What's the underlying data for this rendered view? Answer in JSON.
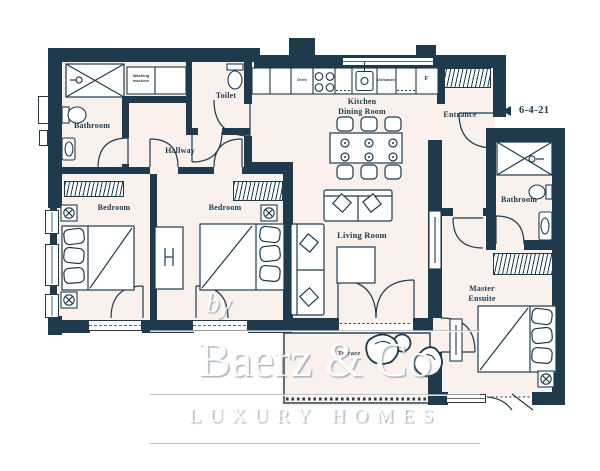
{
  "colors": {
    "wall": "#1f3a4c",
    "floor": "#faf0ec",
    "background": "#ffffff",
    "label_text": "#1f3a4c",
    "watermark_line": "#aab5be"
  },
  "rooms": {
    "bathroom_top": {
      "label": "Bathroom"
    },
    "toilet": {
      "label": "Toilet"
    },
    "hallway": {
      "label": "Hallway"
    },
    "kitchen_dining": {
      "line1": "Kitchen",
      "line2": "Dining Room"
    },
    "entrance": {
      "label": "Entrance"
    },
    "bathroom_right": {
      "label": "Bathroom"
    },
    "bedroom_left": {
      "label": "Bedroom"
    },
    "bedroom_middle": {
      "label": "Bedroom"
    },
    "living_room": {
      "label": "Living Room"
    },
    "master_ensuite": {
      "line1": "Master",
      "line2": "Ensuite"
    },
    "terrace": {
      "label": "Terrace"
    }
  },
  "appliances": {
    "washing_machine": "Washing machine",
    "oven": "Oven",
    "dishwasher": "Dishwasher",
    "fridge": "F"
  },
  "annotation": {
    "marker": "6-4-21"
  },
  "watermark": {
    "prefix": "by",
    "brand": "Baerz & Co",
    "tagline": "LUXURY HOMES"
  }
}
